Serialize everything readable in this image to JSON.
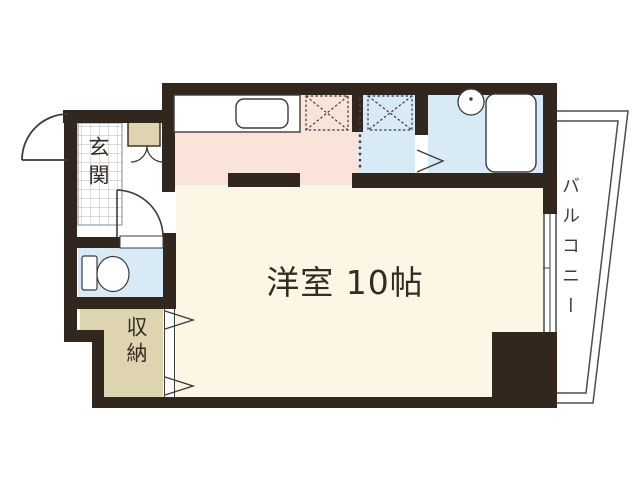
{
  "floorplan": {
    "labels": {
      "main_room": "洋室 10帖",
      "entrance": "玄関",
      "storage": "収納",
      "balcony": "バルコニー"
    },
    "colors": {
      "wall": "#32271e",
      "kitchen_floor": "#fae3d8",
      "main_room_floor": "#fcf7e4",
      "wet_area_floor": "#d8eaf6",
      "storage_floor": "#ded5b0",
      "tile_grid_line": "#b3b3b3",
      "balcony_line": "#4d4d4d",
      "fixture_line": "#3c3c3c"
    },
    "fixture_icons": [
      "kitchen-counter-icon",
      "kitchen-sink-icon",
      "refrigerator-space-icon",
      "washing-machine-space-icon",
      "wash-basin-icon",
      "bathtub-icon",
      "toilet-icon",
      "shoe-cabinet-icon",
      "entrance-door-icon",
      "interior-door-icon",
      "folding-door-icon",
      "accordion-curtain-icon",
      "window-icon",
      "balcony-railing-icon"
    ]
  }
}
